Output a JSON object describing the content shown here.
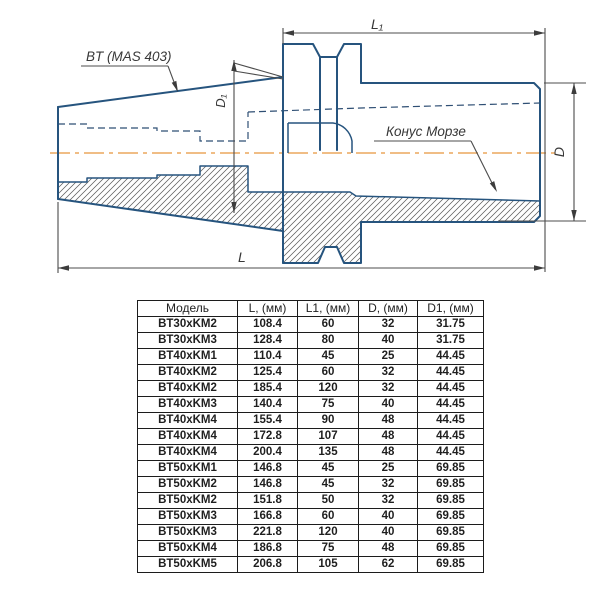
{
  "drawing": {
    "title_label": "BT (MAS 403)",
    "morse_label": "Конус Морзе",
    "dim_l1": "L₁",
    "dim_l": "L",
    "dim_d": "D",
    "dim_d1": "D₁",
    "colors": {
      "outline": "#26547e",
      "hidden_line": "#2f4f74",
      "centerline": "#f0bd85",
      "dimension": "#4c4c4c",
      "hatch": "#5a5a5a"
    }
  },
  "table": {
    "headers": [
      "Модель",
      "L, (мм)",
      "L1, (мм)",
      "D, (мм)",
      "D1, (мм)"
    ],
    "rows": [
      [
        "BT30xKM2",
        "108.4",
        "60",
        "32",
        "31.75"
      ],
      [
        "BT30xKM3",
        "128.4",
        "80",
        "40",
        "31.75"
      ],
      [
        "BT40xKM1",
        "110.4",
        "45",
        "25",
        "44.45"
      ],
      [
        "BT40xKM2",
        "125.4",
        "60",
        "32",
        "44.45"
      ],
      [
        "BT40xKM2",
        "185.4",
        "120",
        "32",
        "44.45"
      ],
      [
        "BT40xKM3",
        "140.4",
        "75",
        "40",
        "44.45"
      ],
      [
        "BT40xKM4",
        "155.4",
        "90",
        "48",
        "44.45"
      ],
      [
        "BT40xKM4",
        "172.8",
        "107",
        "48",
        "44.45"
      ],
      [
        "BT40xKM4",
        "200.4",
        "135",
        "48",
        "44.45"
      ],
      [
        "BT50xKM1",
        "146.8",
        "45",
        "25",
        "69.85"
      ],
      [
        "BT50xKM2",
        "146.8",
        "45",
        "32",
        "69.85"
      ],
      [
        "BT50xKM2",
        "151.8",
        "50",
        "32",
        "69.85"
      ],
      [
        "BT50xKM3",
        "166.8",
        "60",
        "40",
        "69.85"
      ],
      [
        "BT50xKM3",
        "221.8",
        "120",
        "40",
        "69.85"
      ],
      [
        "BT50xKM4",
        "186.8",
        "75",
        "48",
        "69.85"
      ],
      [
        "BT50xKM5",
        "206.8",
        "105",
        "62",
        "69.85"
      ]
    ]
  }
}
